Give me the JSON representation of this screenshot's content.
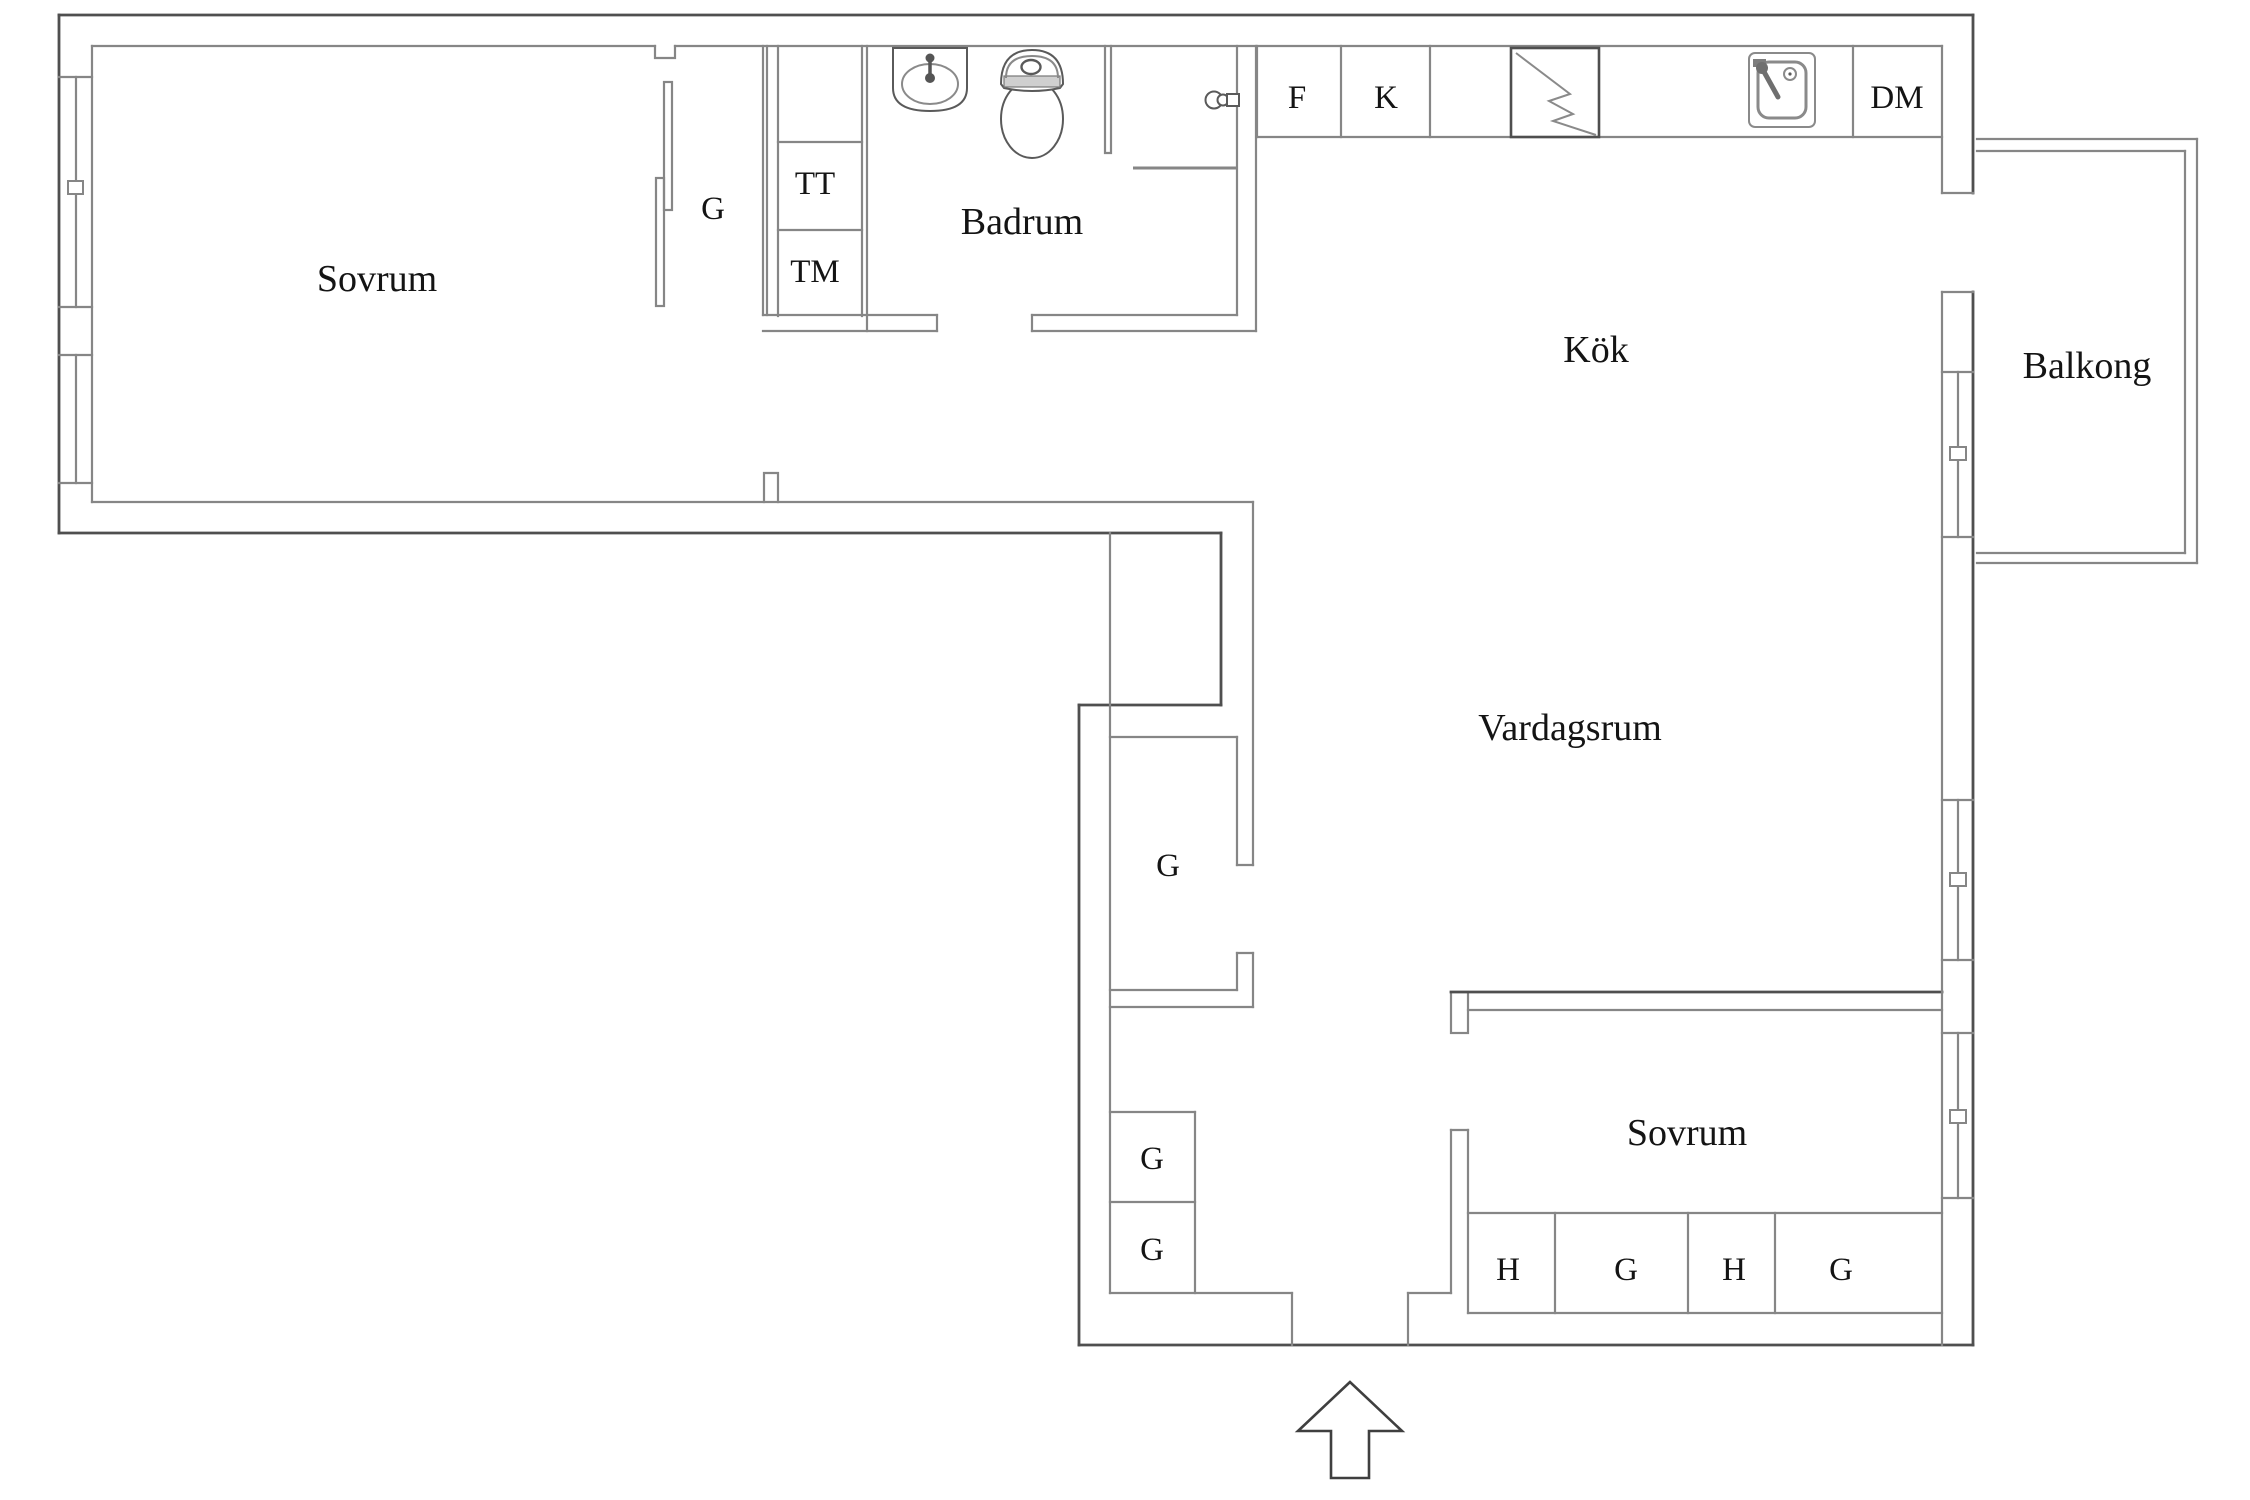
{
  "document": {
    "type": "floor-plan",
    "language": "sv"
  },
  "colors": {
    "background": "#ffffff",
    "wall": "#868686",
    "wall_dark": "#4f4f4f",
    "text": "#141414",
    "toilet_band": "#cfcfcf"
  },
  "labels": {
    "sovrum_main": "Sovrum",
    "wardrobe_main": "G",
    "dryer": "TT",
    "washer": "TM",
    "badrum": "Badrum",
    "freezer": "F",
    "fridge": "K",
    "dishwasher": "DM",
    "kok": "Kök",
    "balkong": "Balkong",
    "vardagsrum": "Vardagsrum",
    "wardrobe_mid": "G",
    "wardrobe_hall_upper": "G",
    "wardrobe_hall_lower": "G",
    "sovrum_second": "Sovrum",
    "shelf_a": "H",
    "wardrobe_bed_a": "G",
    "shelf_b": "H",
    "wardrobe_bed_b": "G"
  },
  "icons": {
    "stove": "electric-stove-lightning-square",
    "kitchen_sink": "kitchen-sink-with-faucet",
    "bathroom_sink": "washbasin-with-faucet",
    "toilet": "toilet-top-view",
    "shower_mixer": "wall-mounted-shower-mixer",
    "entrance_arrow": "arrow-up-entrance"
  },
  "entrance": {
    "direction": "up"
  }
}
